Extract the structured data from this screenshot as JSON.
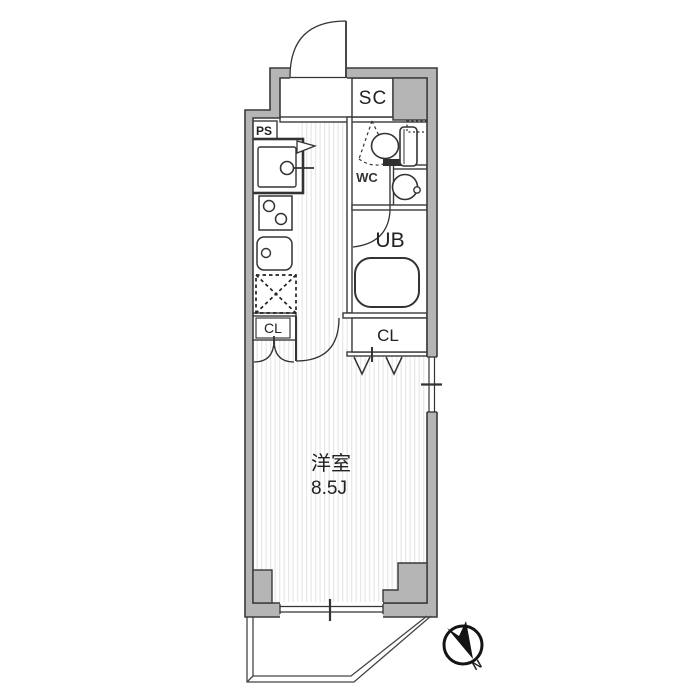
{
  "plan": {
    "type": "floor-plan",
    "labels": {
      "shoe_closet": "SC",
      "pipe_space": "PS",
      "toilet": "WC",
      "unit_bath": "UB",
      "closet_left": "CL",
      "closet_right": "CL",
      "room_name": "洋室",
      "room_size": "8.5J",
      "compass_north": "N"
    },
    "rooms": [
      {
        "name": "洋室",
        "size_tatami": "8.5J"
      },
      {
        "name": "SC"
      },
      {
        "name": "WC"
      },
      {
        "name": "UB"
      },
      {
        "name": "CL"
      },
      {
        "name": "CL"
      },
      {
        "name": "PS"
      }
    ],
    "colors": {
      "wall_fill": "#b5b5b5",
      "outline": "#3a3a3a",
      "floor_stripe": "#e9e9e9",
      "background": "#ffffff",
      "compass": "#141414"
    }
  }
}
